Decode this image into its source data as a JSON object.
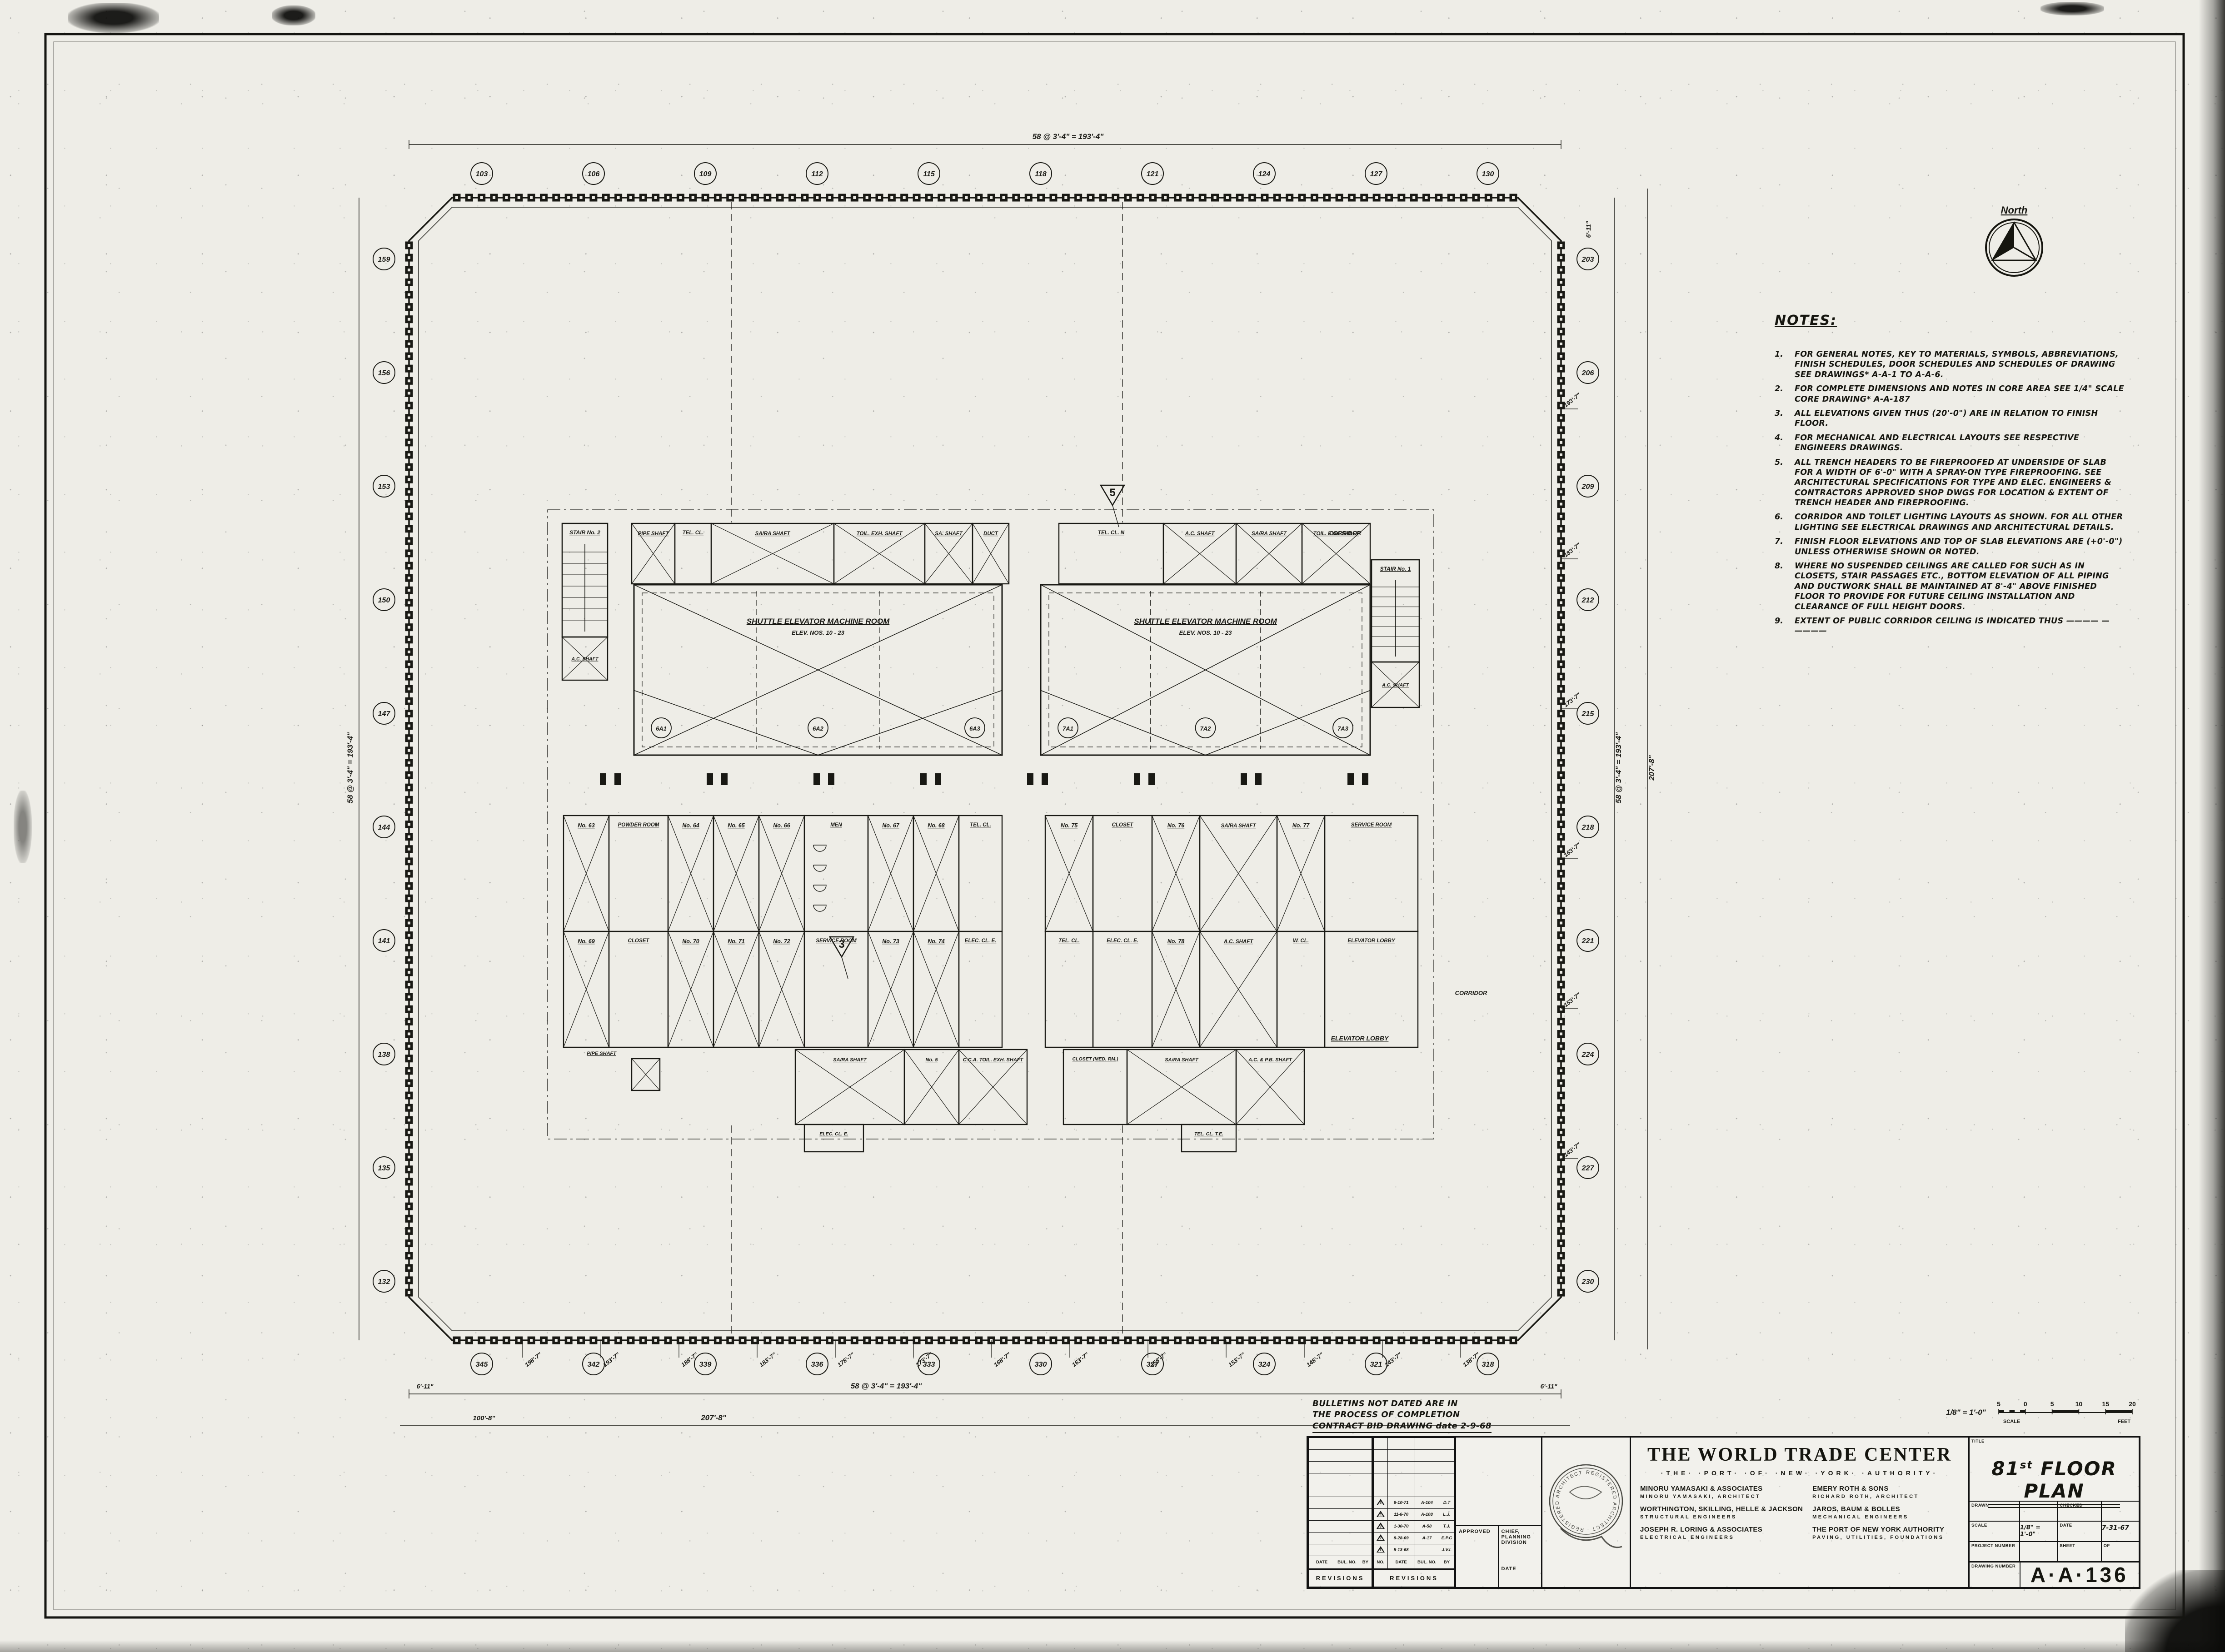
{
  "north_arrow": {
    "label": "North"
  },
  "notes": {
    "title": "NOTES:",
    "items": [
      {
        "num": "1.",
        "text": "FOR GENERAL NOTES, KEY TO MATERIALS, SYMBOLS, ABBREVIATIONS, FINISH SCHEDULES, DOOR SCHEDULES AND SCHEDULES OF DRAWING SEE DRAWINGS* A-A-1 TO A-A-6."
      },
      {
        "num": "2.",
        "text": "FOR COMPLETE DIMENSIONS AND NOTES IN CORE AREA SEE 1/4\" SCALE CORE DRAWING* A-A-187"
      },
      {
        "num": "3.",
        "text": "ALL ELEVATIONS GIVEN THUS (20'-0\") ARE IN RELATION TO FINISH FLOOR."
      },
      {
        "num": "4.",
        "text": "FOR MECHANICAL AND ELECTRICAL LAYOUTS SEE RESPECTIVE ENGINEERS DRAWINGS."
      },
      {
        "num": "5.",
        "text": "ALL TRENCH HEADERS TO BE FIREPROOFED AT UNDERSIDE OF SLAB FOR A WIDTH OF 6'-0\" WITH A SPRAY-ON TYPE FIREPROOFING. SEE ARCHITECTURAL SPECIFICATIONS FOR TYPE AND ELEC. ENGINEERS & CONTRACTORS APPROVED SHOP DWGS FOR LOCATION & EXTENT OF TRENCH HEADER AND FIREPROOFING."
      },
      {
        "num": "6.",
        "text": "CORRIDOR AND TOILET LIGHTING LAYOUTS AS SHOWN. FOR ALL OTHER LIGHTING SEE ELECTRICAL DRAWINGS AND ARCHITECTURAL DETAILS."
      },
      {
        "num": "7.",
        "text": "FINISH FLOOR ELEVATIONS AND TOP OF SLAB ELEVATIONS ARE (+0'-0\") UNLESS OTHERWISE SHOWN OR NOTED."
      },
      {
        "num": "8.",
        "text": "WHERE NO SUSPENDED CEILINGS ARE CALLED FOR SUCH AS IN CLOSETS, STAIR PASSAGES ETC., BOTTOM ELEVATION OF ALL PIPING AND DUCTWORK SHALL BE MAINTAINED AT 8'-4\" ABOVE FINISHED FLOOR TO PROVIDE FOR FUTURE CEILING INSTALLATION AND CLEARANCE OF FULL HEIGHT DOORS."
      },
      {
        "num": "9.",
        "text": "EXTENT OF PUBLIC CORRIDOR CEILING IS INDICATED THUS  ————  —  ————"
      }
    ]
  },
  "bulletin_note": {
    "line1": "BULLETINS NOT DATED ARE IN",
    "line2": "THE PROCESS OF COMPLETION",
    "line3": "CONTRACT   BID   DRAWING   date 2-9-68"
  },
  "plan": {
    "core": {
      "machine_room_label": "SHUTTLE ELEVATOR MACHINE ROOM",
      "machine_room_sub": "ELEV. NOS. 10 - 23",
      "refs_left": [
        "6A1",
        "6A2",
        "6A3"
      ],
      "refs_right": [
        "7A1",
        "7A2",
        "7A3"
      ],
      "shafts": {
        "pipe": "PIPE SHAFT",
        "telcl": "TEL. CL.",
        "sara": "SA/RA SHAFT",
        "toilexh": "TOIL. EXH. SHAFT",
        "sashaft": "SA. SHAFT",
        "duct": "DUCT",
        "telcln": "TEL. CL. N",
        "ac": "A.C. SHAFT",
        "acpb": "A.C. & P.B. SHAFT",
        "ccatoil": "C.C.A. TOIL. EXH. SHAFT",
        "no5": "No. 5"
      },
      "rooms": {
        "men": "MEN",
        "powder": "POWDER ROOM",
        "closet": "CLOSET",
        "service": "SERVICE ROOM",
        "wcl": "W. CL.",
        "telcl": "TEL. CL.",
        "eleccl": "ELEC. CL. E.",
        "closet_med": "CLOSET (MED. RM.)",
        "telcl_te": "TEL. CL. T.E.",
        "elevator_lobby": "ELEVATOR LOBBY",
        "corridor": "CORRIDOR"
      },
      "stair_left": "STAIR No. 2",
      "stair_right": "STAIR No. 1",
      "elevator_numbers": [
        "No. 63",
        "No. 64",
        "No. 65",
        "No. 66",
        "No. 67",
        "No. 68",
        "No. 69",
        "No. 70",
        "No. 71",
        "No. 72",
        "No. 73",
        "No. 74",
        "No. 75",
        "No. 76",
        "No. 77",
        "No. 78"
      ],
      "detail_markers": [
        "5",
        "3"
      ]
    },
    "grid": {
      "top": [
        "103",
        "106",
        "109",
        "112",
        "115",
        "118",
        "121",
        "124",
        "127",
        "130"
      ],
      "right": [
        "203",
        "206",
        "209",
        "212",
        "215",
        "218",
        "221",
        "224",
        "227",
        "230"
      ],
      "bottom": [
        "345",
        "342",
        "339",
        "336",
        "333",
        "330",
        "327",
        "324",
        "321",
        "318"
      ],
      "left": [
        "159",
        "156",
        "153",
        "150",
        "147",
        "144",
        "141",
        "138",
        "135",
        "132"
      ]
    },
    "dimensions": {
      "run": "58 @ 3'-4\" = 193'-4\"",
      "overall": "207'-8\"",
      "corner": "6'-11\"",
      "left_partial": "100'-8\""
    },
    "leader_dims_bottom": [
      "198'-7\"",
      "193'-7\"",
      "188'-7\"",
      "183'-7\"",
      "178'-7\"",
      "173'-7\"",
      "168'-7\"",
      "163'-7\"",
      "158'-7\"",
      "153'-7\"",
      "148'-7\"",
      "143'-7\"",
      "138'-7\""
    ],
    "leader_dims_right": [
      "193'-7\"",
      "183'-7\"",
      "173'-7\"",
      "163'-7\"",
      "153'-7\"",
      "143'-7\""
    ]
  },
  "scale_bar": {
    "ratio": "1/8\" = 1'-0\"",
    "ticks": [
      "5",
      "0",
      "5",
      "10",
      "15",
      "20"
    ],
    "label": "SCALE",
    "unit": "FEET"
  },
  "title_block": {
    "project_title": "THE WORLD TRADE CENTER",
    "authority": "·THE· ·PORT· ·OF· ·NEW· ·YORK· ·AUTHORITY·",
    "firms": [
      {
        "name": "MINORU YAMASAKI & ASSOCIATES",
        "role": "MINORU YAMASAKI, ARCHITECT"
      },
      {
        "name": "EMERY ROTH & SONS",
        "role": "RICHARD ROTH, ARCHITECT"
      },
      {
        "name": "WORTHINGTON, SKILLING, HELLE & JACKSON",
        "role": "STRUCTURAL ENGINEERS"
      },
      {
        "name": "JAROS, BAUM & BOLLES",
        "role": "MECHANICAL ENGINEERS"
      },
      {
        "name": "JOSEPH R. LORING & ASSOCIATES",
        "role": "ELECTRICAL ENGINEERS"
      },
      {
        "name": "THE PORT OF NEW YORK AUTHORITY",
        "role": "PAVING, UTILITIES, FOUNDATIONS"
      }
    ],
    "stamp_text": "REGISTERED ARCHITECT · REGISTERED ARCHITECT ·",
    "approved_label": "APPROVED",
    "chief_label": "CHIEF, PLANNING DIVISION",
    "chief_date_label": "DATE",
    "title_label": "TITLE",
    "title_num": "81",
    "title_sup": "st",
    "title_rest": " FLOOR PLAN",
    "fields": {
      "drawn_label": "DRAWN",
      "drawn_value": "",
      "checked_label": "CHECKED",
      "checked_value": "",
      "scale_label": "SCALE",
      "scale_value": "1/8\" = 1'-0\"",
      "date_label": "DATE",
      "date_value": "7-31-67",
      "project_number_label": "PROJECT NUMBER",
      "project_number_value": "",
      "sheet_label": "SHEET",
      "of_label": "OF",
      "drawing_number_label": "DRAWING NUMBER",
      "drawing_number_value": "A·A·136"
    }
  },
  "revisions": {
    "left_headers": [
      "DATE",
      "BUL. NO.",
      "BY"
    ],
    "left_title": "REVISIONS",
    "right_headers": [
      "NO.",
      "DATE",
      "BUL. NO.",
      "BY"
    ],
    "right_title": "REVISIONS",
    "entries": [
      {
        "no": "5",
        "date": "6-10-71",
        "bul": "A-104",
        "by": "D.T"
      },
      {
        "no": "4",
        "date": "11-6-70",
        "bul": "A-108",
        "by": "L.J."
      },
      {
        "no": "3",
        "date": "1-30-70",
        "bul": "A-58",
        "by": "T.J."
      },
      {
        "no": "2",
        "date": "8-28-69",
        "bul": "A-17",
        "by": "E.P.C"
      },
      {
        "no": "1",
        "date": "5-13-68",
        "bul": "",
        "by": "J.V.L"
      }
    ]
  }
}
